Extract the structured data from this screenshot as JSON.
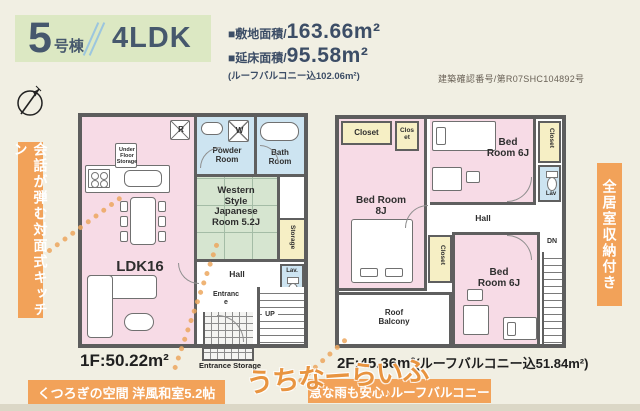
{
  "header": {
    "unit_number": "5",
    "unit_suffix": "号棟",
    "layout_type": "4LDK",
    "site_area_label": "■敷地面積/",
    "site_area_value": "163.66m²",
    "floor_area_label": "■延床面積/",
    "floor_area_value": "95.58m²",
    "floor_area_note": "(ルーフバルコニー込102.06m²)",
    "confirmation_number": "建築確認番号/第R07SHC104892号"
  },
  "banners": {
    "left_vertical": "会話が弾む対面式キッチン",
    "right_vertical": "全居室収納付き",
    "bottom_left": "くつろぎの空間 洋風和室5.2帖",
    "bottom_right": "急な雨も安心♪ルーフバルコニー"
  },
  "floor1": {
    "area_label": "1F:50.22m²",
    "ldk": "LDK16",
    "powder_room": "Powder Room",
    "bath_room": "Bath Room",
    "japanese_room": "Western Style Japanese Room 5.2J",
    "storage": "Storage",
    "hall": "Hall",
    "lav": "Lav.",
    "entrance": "Entrance",
    "entrance_storage": "Entrance Storage",
    "under_floor_storage": "Under Floor Storage",
    "fridge_mark": "R",
    "washer_mark": "W",
    "stairs_up": "UP"
  },
  "floor2": {
    "area_label": "2F:45.36m²",
    "area_note": "(ルーフバルコニー込51.84m²)",
    "bedroom_8j": "Bed Room 8J",
    "bedroom_6j_top": "Bed Room 6J",
    "bedroom_6j_bottom": "Bed Room 6J",
    "closet_main": "Closet",
    "closet_small": "Closet",
    "closet_right": "Closet",
    "closet_mid": "Closet",
    "lav": "Lav",
    "hall": "Hall",
    "roof_balcony": "Roof Balcony",
    "stairs_down": "DN"
  },
  "watermark": "うちなーらいふ",
  "colors": {
    "background": "#f1efe3",
    "header_band": "#dce8c3",
    "header_text": "#46586d",
    "accent_orange": "#f2a259",
    "room_pink": "#f7dbe6",
    "room_blue": "#cde4f1",
    "room_green": "#d6e5d0",
    "room_yellow": "#f6efc5",
    "wall": "#5d5d5d",
    "watermark_orange": "#e89440"
  }
}
